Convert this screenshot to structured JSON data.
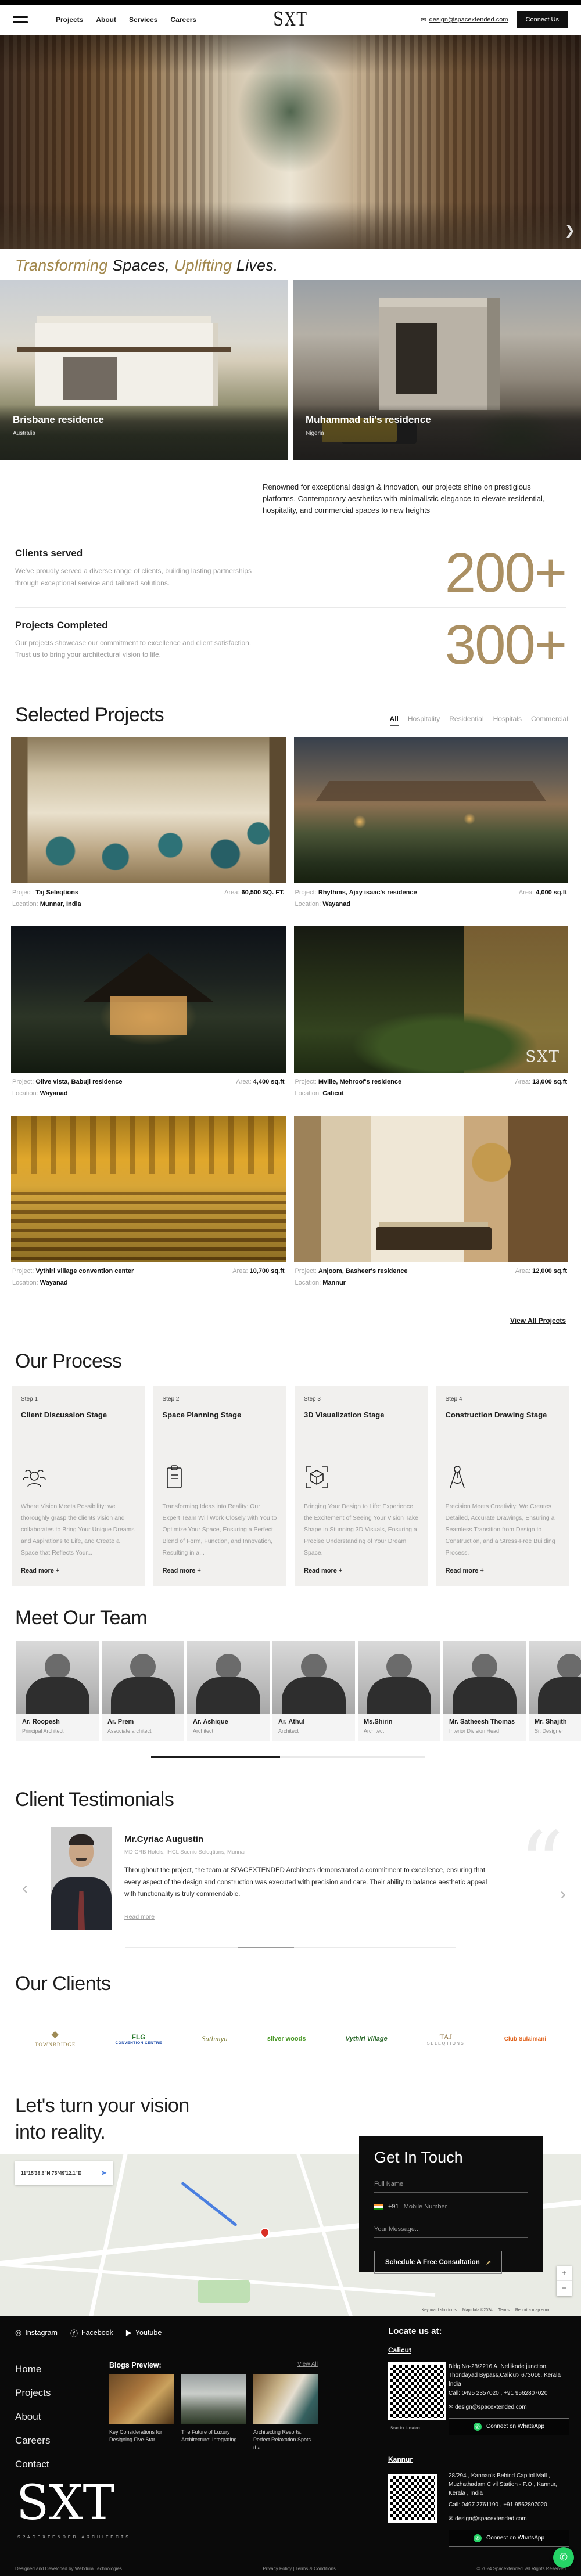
{
  "header": {
    "nav": [
      "Projects",
      "About",
      "Services",
      "Careers"
    ],
    "logo": "SXT",
    "email": "design@spacextended.com",
    "connect_label": "Connect Us"
  },
  "tagline": {
    "t1": "Transforming ",
    "t2": "Spaces, ",
    "t3": "Uplifting ",
    "t4": "Lives."
  },
  "carousel": {
    "slides": [
      {
        "title": "Brisbane residence",
        "location": "Australia"
      },
      {
        "title": "Muhammad ali's residence",
        "location": "Nigeria"
      }
    ]
  },
  "intro": "Renowned for exceptional design & innovation, our projects shine on prestigious platforms. Contemporary aesthetics with minimalistic elegance to elevate residential, hospitality, and commercial spaces to new heights",
  "stats": [
    {
      "title": "Clients served",
      "desc": "We've proudly served a diverse range of clients, building lasting partnerships through exceptional service and tailored solutions.",
      "value": "200+"
    },
    {
      "title": "Projects Completed",
      "desc": "Our projects showcase our commitment to excellence and client satisfaction. Trust us to bring your architectural vision to life.",
      "value": "300+"
    }
  ],
  "projects": {
    "heading": "Selected Projects",
    "filters": [
      "All",
      "Hospitality",
      "Residential",
      "Hospitals",
      "Commercial"
    ],
    "labels": {
      "project": "Project:",
      "area": "Area:",
      "location": "Location:"
    },
    "view_all": "View All Projects",
    "watermark": "SXT",
    "cards": [
      {
        "project": "Taj Seleqtions",
        "area": "60,500 SQ. FT.",
        "location": "Munnar, India"
      },
      {
        "project": "Rhythms, Ajay isaac's residence",
        "area": "4,000 sq.ft",
        "location": "Wayanad"
      },
      {
        "project": "Olive vista, Babuji residence",
        "area": "4,400 sq.ft",
        "location": "Wayanad"
      },
      {
        "project": "Mville, Mehroof's residence",
        "area": "13,000 sq.ft",
        "location": "Calicut"
      },
      {
        "project": "Vythiri village convention center",
        "area": "10,700 sq.ft",
        "location": "Wayanad"
      },
      {
        "project": "Anjoom, Basheer's residence",
        "area": "12,000 sq.ft",
        "location": "Mannur"
      }
    ]
  },
  "process": {
    "heading": "Our Process",
    "read_more": "Read more +",
    "steps": [
      {
        "step": "Step 1",
        "title": "Client Discussion Stage",
        "desc": "Where Vision Meets Possibility: we thoroughly grasp the clients vision and collaborates to Bring Your Unique Dreams and Aspirations to Life, and Create a Space that Reflects Your..."
      },
      {
        "step": "Step 2",
        "title": "Space Planning Stage",
        "desc": "Transforming Ideas into Reality: Our Expert Team Will Work Closely with You to Optimize Your Space, Ensuring a Perfect Blend of Form, Function, and Innovation, Resulting in a..."
      },
      {
        "step": "Step 3",
        "title": "3D Visualization Stage",
        "desc": "Bringing Your Design to Life: Experience the Excitement of Seeing Your Vision Take Shape in Stunning 3D Visuals, Ensuring a Precise Understanding of Your Dream Space."
      },
      {
        "step": "Step 4",
        "title": "Construction Drawing Stage",
        "desc": "Precision Meets Creativity: We Creates Detailed, Accurate Drawings, Ensuring a Seamless Transition from Design to Construction, and a Stress-Free Building Process."
      }
    ]
  },
  "team": {
    "heading": "Meet Our Team",
    "members": [
      {
        "name": "Ar. Roopesh",
        "role": "Principal Architect"
      },
      {
        "name": "Ar. Prem",
        "role": "Associate architect"
      },
      {
        "name": "Ar. Ashique",
        "role": "Architect"
      },
      {
        "name": "Ar. Athul",
        "role": "Architect"
      },
      {
        "name": "Ms.Shirin",
        "role": "Architect"
      },
      {
        "name": "Mr. Satheesh Thomas",
        "role": "Interior Division Head"
      },
      {
        "name": "Mr. Shajith",
        "role": "Sr. Designer"
      }
    ]
  },
  "testimonials": {
    "heading": "Client Testimonials",
    "name": "Mr.Cyriac Augustin",
    "title": "MD CRB Hotels, IHCL Scenic Seleqtions, Munnar",
    "quote": "Throughout the project, the team at SPACEXTENDED Architects demonstrated a commitment to excellence, ensuring that every aspect of the design and construction was executed with precision and care. Their ability to balance aesthetic appeal with functionality is truly commendable.",
    "read_more": "Read more",
    "quote_mark": "“"
  },
  "clients": {
    "heading": "Our Clients",
    "logos": [
      {
        "name": "TOWNBRIDGE",
        "sub": ""
      },
      {
        "name": "FLG",
        "sub": "CONVENTION CENTRE"
      },
      {
        "name": "Sathmya",
        "sub": ""
      },
      {
        "name": "silver woods",
        "sub": ""
      },
      {
        "name": "Vythiri Village",
        "sub": ""
      },
      {
        "name": "TAJ",
        "sub": "SELEQTIONS"
      },
      {
        "name": "Club Sulaimani",
        "sub": ""
      }
    ]
  },
  "cta": {
    "line1": "Let's turn your vision",
    "line2": "into reality."
  },
  "map": {
    "search": "11°15'38.6\"N 75°49'12.1\"E",
    "zoom_in": "+",
    "zoom_out": "−",
    "attr1": "Keyboard shortcuts",
    "attr2": "Map data ©2024",
    "attr3": "Terms",
    "attr4": "Report a map error"
  },
  "form": {
    "heading": "Get In Touch",
    "name_placeholder": "Full Name",
    "phone_code": "+91",
    "phone_placeholder": "Mobile Number",
    "message_placeholder": "Your Message...",
    "submit": "Schedule A Free Consultation",
    "submit_arrow": "↗"
  },
  "footer": {
    "social": [
      "Instagram",
      "Facebook",
      "Youtube"
    ],
    "nav": [
      "Home",
      "Projects",
      "About",
      "Careers",
      "Contact"
    ],
    "blogs": {
      "heading": "Blogs Preview:",
      "view_all": "View All",
      "items": [
        "Key Considerations for Designing Five-Star...",
        "The Future of Luxury Architecture: Integrating...",
        "Architecting Resorts: Perfect Relaxation Spots that..."
      ]
    },
    "locate_heading": "Locate us at:",
    "offices": [
      {
        "city": "Calicut",
        "address": "Bldg No-28/2216 A, Nellikode junction, Thondayad Bypass,Calicut- 673016, Kerala India",
        "phone": "Call: 0495 2357020 , +91 9562807020",
        "email": "design@spacextended.com",
        "whatsapp": "Connect on WhatsApp",
        "scan": "Scan for Location"
      },
      {
        "city": "Kannur",
        "address": "28/294 , Kannan's Behind Capitol Mall , Muzhathadam Civil Station - P.O , Kannur, Kerala , India",
        "phone": "Call: 0497 2761190 , +91 9562807020",
        "email": "design@spacextended.com",
        "whatsapp": "Connect on WhatsApp"
      }
    ],
    "logo": "SXT",
    "logo_sub": "SPACEXTENDED ARCHITECTS",
    "bottom": {
      "left": "Designed and Developed by Webdura Technologies",
      "center": "Privacy Policy | Terms & Conditions",
      "right": "© 2024 Spacextended. All Rights Reserved"
    }
  }
}
